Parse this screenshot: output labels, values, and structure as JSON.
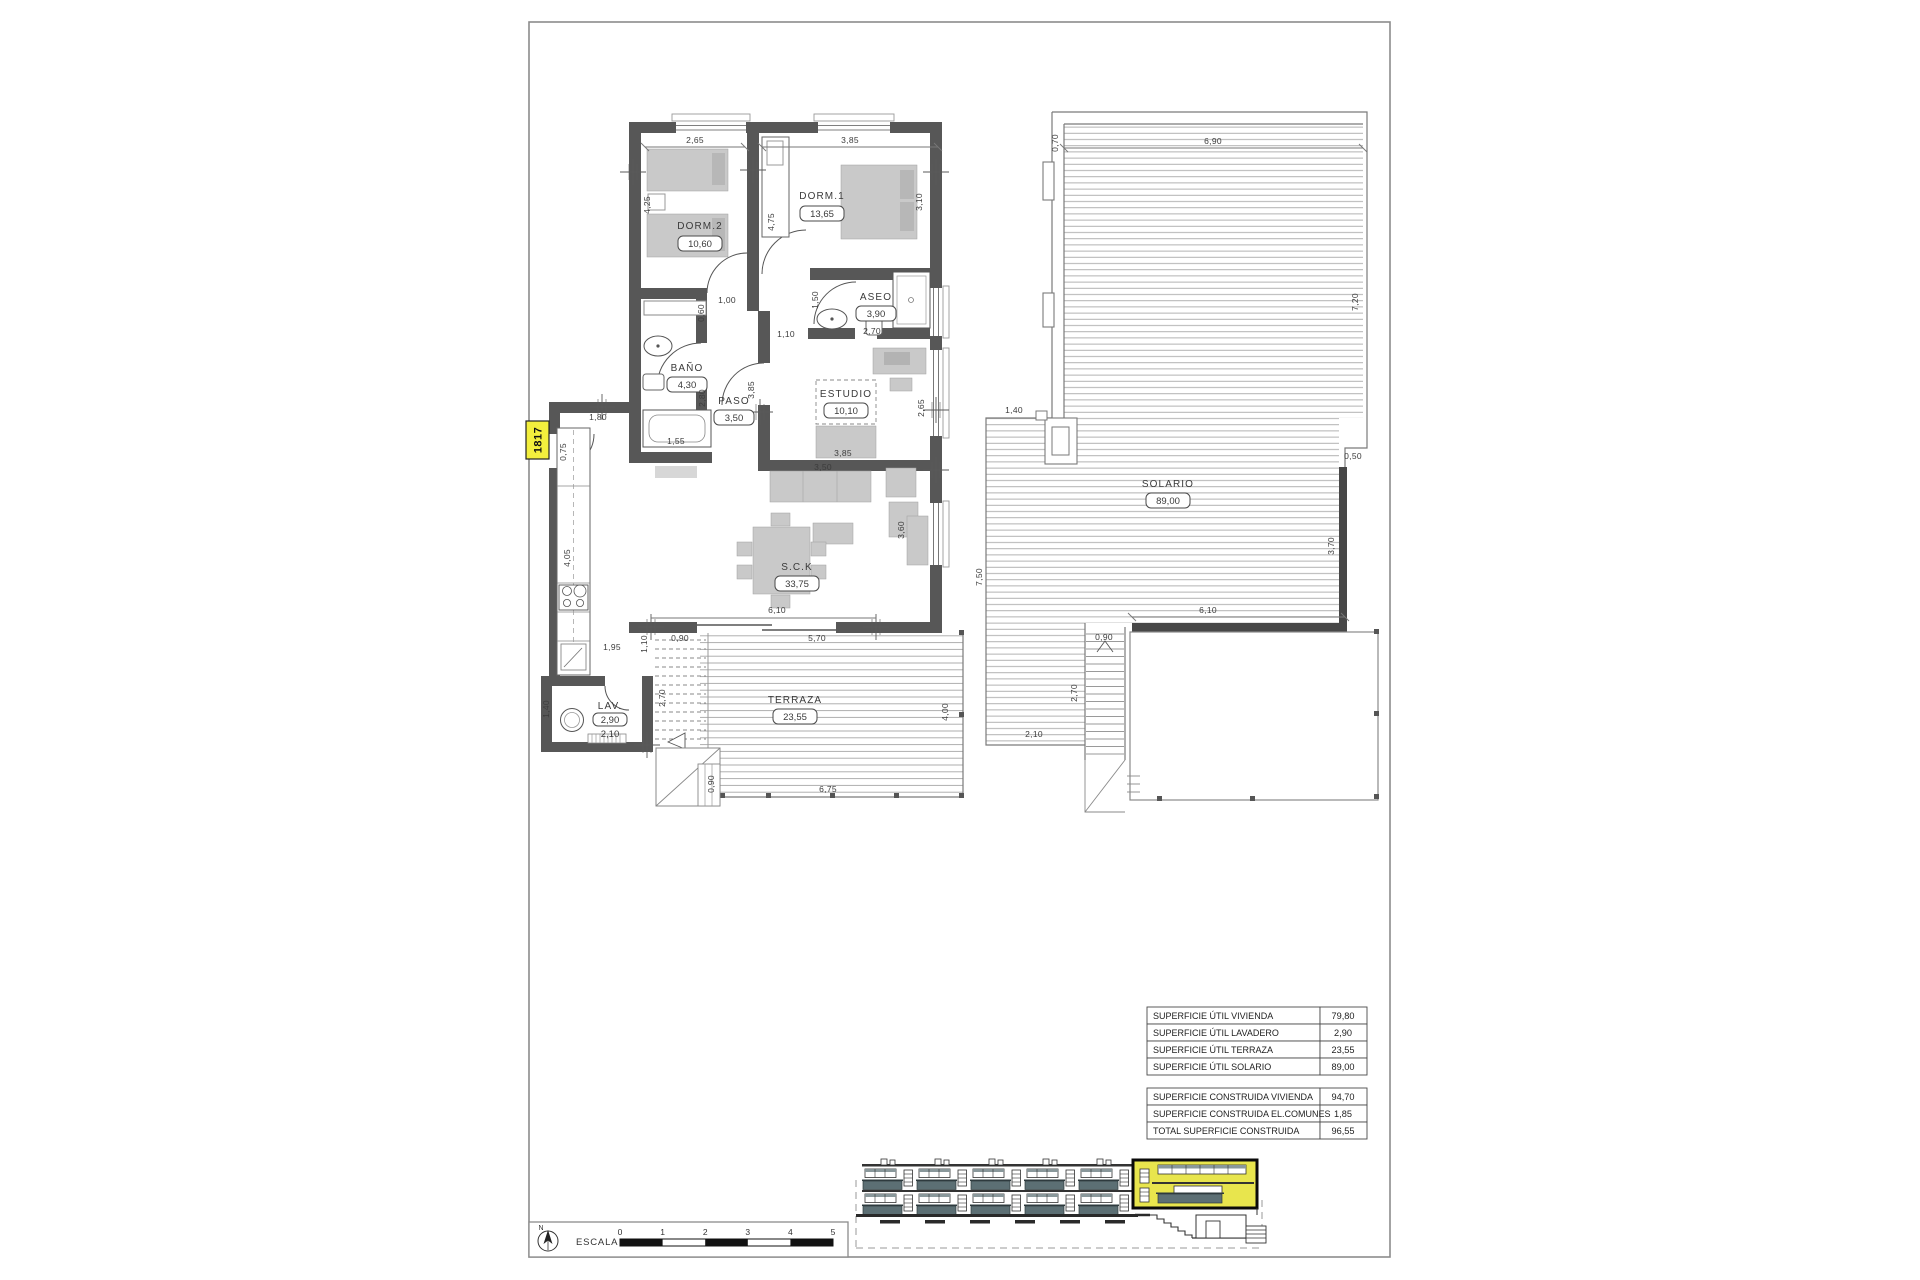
{
  "drawing": {
    "tag": "1817"
  },
  "rooms": {
    "dorm2": {
      "name": "DORM.2",
      "area": "10,60"
    },
    "dorm1": {
      "name": "DORM.1",
      "area": "13,65"
    },
    "aseo": {
      "name": "ASEO",
      "area": "3,90"
    },
    "bano": {
      "name": "BAÑO",
      "area": "4,30"
    },
    "paso": {
      "name": "PASO",
      "area": "3,50"
    },
    "estudio": {
      "name": "ESTUDIO",
      "area": "10,10"
    },
    "sck": {
      "name": "S.C.K",
      "area": "33,75"
    },
    "lav": {
      "name": "LAV.",
      "area": "2,90",
      "area2": "2,10"
    },
    "terraza": {
      "name": "TERRAZA",
      "area": "23,55"
    },
    "solario": {
      "name": "SOLARIO",
      "area": "89,00"
    }
  },
  "dims": {
    "plan": {
      "d265a": "2,65",
      "d385a": "3,85",
      "d425": "4,25",
      "d475": "4,75",
      "d310": "3,10",
      "d100": "1,00",
      "d060": "0,60",
      "d150": "1,50",
      "d270a": "2,70",
      "d110a": "1,10",
      "d385b": "3,85",
      "d280": "2,80",
      "d155": "1,55",
      "d180": "1,80",
      "d075": "0,75",
      "d385c": "3,85",
      "d350b": "3,50",
      "d265b": "2,65",
      "d360": "3,60",
      "d405": "4,05",
      "d195": "1,95",
      "d110b": "1,10",
      "d090a": "0,90",
      "d610": "6,10",
      "d570": "5,70",
      "d270b": "2,70",
      "d400": "4,00",
      "d090b": "0,90",
      "d675": "6,75",
      "d140": "1,40"
    },
    "solario": {
      "d070": "0,70",
      "d690": "6,90",
      "d720": "7,20",
      "d140": "1,40",
      "d050": "0,50",
      "d370": "3,70",
      "d750": "7,50",
      "d610": "6,10",
      "d090": "0,90",
      "d270": "2,70",
      "d210": "2,10"
    }
  },
  "table": {
    "util": [
      {
        "label": "SUPERFICIE ÚTIL VIVIENDA",
        "value": "79,80"
      },
      {
        "label": "SUPERFICIE ÚTIL LAVADERO",
        "value": "2,90"
      },
      {
        "label": "SUPERFICIE ÚTIL TERRAZA",
        "value": "23,55"
      },
      {
        "label": "SUPERFICIE ÚTIL SOLARIO",
        "value": "89,00"
      }
    ],
    "construida": [
      {
        "label": "SUPERFICIE CONSTRUIDA VIVIENDA",
        "value": "94,70"
      },
      {
        "label": "SUPERFICIE CONSTRUIDA EL.COMUNES",
        "value": "1,85"
      },
      {
        "label": "TOTAL SUPERFICIE CONSTRUIDA",
        "value": "96,55"
      }
    ]
  },
  "scale_bar": {
    "label": "ESCALA :",
    "north": "N",
    "ticks": [
      "0",
      "1",
      "2",
      "3",
      "4",
      "5"
    ]
  },
  "colors": {
    "wall": "#575757",
    "highlight": "#e8e54d",
    "tag_bg": "#f3ef3d",
    "rail": "#5c6f74"
  }
}
